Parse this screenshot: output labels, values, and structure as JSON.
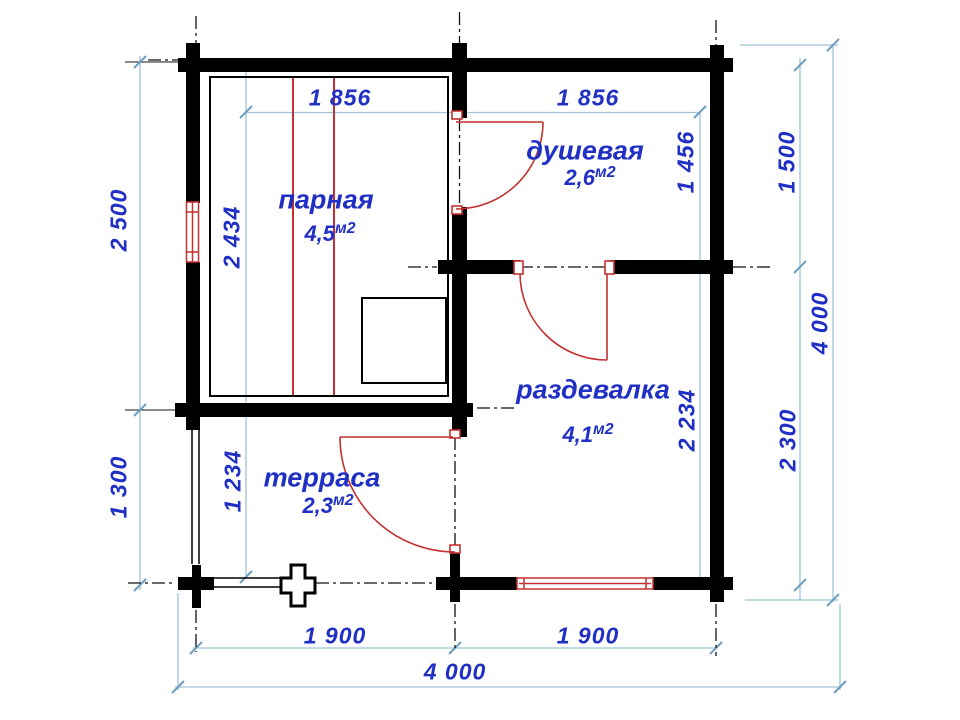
{
  "drawing_type": "floor plan",
  "rooms": [
    {
      "name": "парная",
      "area": "4,5",
      "unit": "м2"
    },
    {
      "name": "душевая",
      "area": "2,6",
      "unit": "м2"
    },
    {
      "name": "раздевалка",
      "area": "4,1",
      "unit": "м2"
    },
    {
      "name": "терраса",
      "area": "2,3",
      "unit": "м2"
    }
  ],
  "dims": {
    "top_left": "1 856",
    "top_right": "1 856",
    "left_upper": "2 500",
    "left_lower": "1 300",
    "parnaya_inner": "2 434",
    "terrace_inner": "1 234",
    "shower_inner": "1 456",
    "changing_inner": "2 234",
    "right_upper": "1 500",
    "right_lower": "2 300",
    "right_total": "4 000",
    "bottom_left": "1 900",
    "bottom_right": "1 900",
    "bottom_total": "4 000"
  },
  "colors": {
    "text": "#2130c4",
    "wall": "#000000",
    "dim_line": "#9fc3d7",
    "tick": "#6f9fc0",
    "red": "#c53030"
  }
}
